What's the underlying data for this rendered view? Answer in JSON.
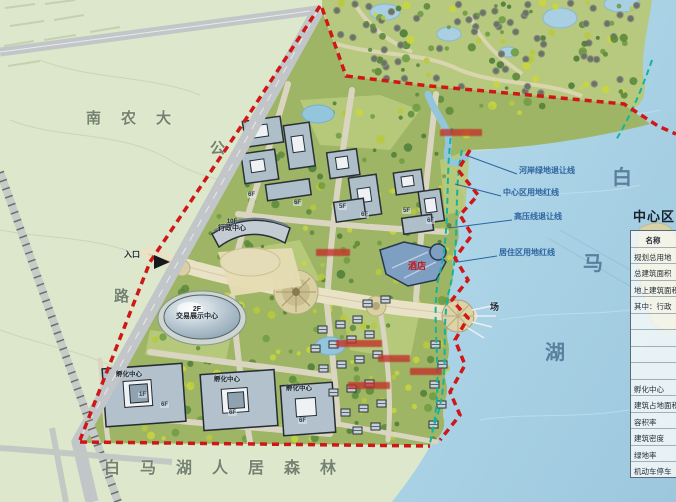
{
  "map": {
    "area_labels": {
      "university": "南农大",
      "road_part1": "公",
      "road_part2": "路",
      "forest_belt": "白马湖人居森林",
      "lake_part1": "白",
      "lake_part2": "马",
      "lake_part3": "湖",
      "plaza": "场",
      "entrance": "入口"
    },
    "building_labels": {
      "admin_floors": "10F",
      "admin_name": "行政中心",
      "expo_floors": "2F",
      "expo_name": "交易展示中心",
      "hotel": "酒店",
      "incubator1": "孵化中心",
      "incubator2": "孵化中心",
      "incubator3": "孵化中心"
    },
    "floor_tags": [
      "6F",
      "6F",
      "5F",
      "6F",
      "5F",
      "6F",
      "6F",
      "6F",
      "6F",
      "1F"
    ],
    "setback_callouts": [
      "河岸绿地退让线",
      "中心区用地红线",
      "高压线退让线",
      "居住区用地红线"
    ]
  },
  "legend": {
    "title": "中心区",
    "header": "名称",
    "rows": [
      "规划总用地",
      "总建筑面积",
      "地上建筑面积",
      "其中：行政",
      "",
      "",
      "",
      "",
      "孵化中心",
      "建筑占地面积",
      "容积率",
      "建筑密度",
      "绿地率",
      "机动车停车"
    ]
  },
  "colors": {
    "boundary_red": "#cf1717",
    "setback_teal": "#14b39e",
    "callout_blue": "#2e64a0",
    "lake_blue": "#a9d0e4",
    "site_green": "#9db564",
    "field_green": "#dde7cb",
    "road_beige": "#e9e2c6"
  }
}
